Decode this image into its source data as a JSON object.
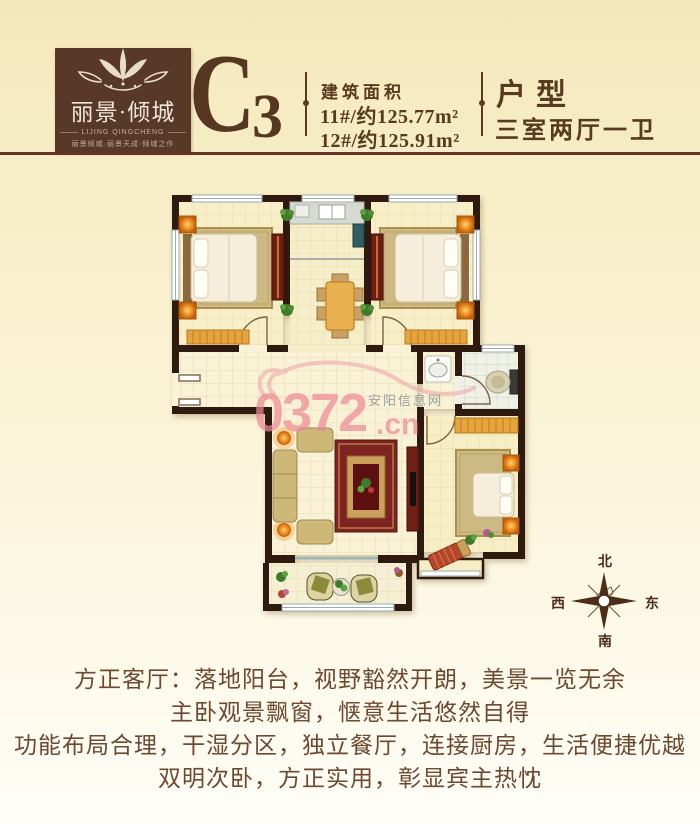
{
  "header": {
    "logo": {
      "brand": "丽景·倾城",
      "brand_en": "LIJING QINGCHENG",
      "tagline": "丽景倾城·丽景天成·倾城之作"
    },
    "unit_code": "C",
    "unit_sub": "3",
    "area": {
      "label": "建筑面积",
      "line1": "11#/约125.77m²",
      "line2": "12#/约125.91m²"
    },
    "type": {
      "label": "户型",
      "value": "三室两厅一卫"
    }
  },
  "watermark": {
    "big": "0372",
    "suffix": ".cn",
    "site": "安阳信息网"
  },
  "compass": {
    "north": "北",
    "south": "南",
    "east": "东",
    "west": "西"
  },
  "description": {
    "lines": [
      "方正客厅：落地阳台，视野豁然开朗，美景一览无余",
      "主卧观景飘窗，惬意生活悠然自得",
      "功能布局合理，干湿分区，独立餐厅，连接厨房，生活便捷优越",
      "双明次卧，方正实用，彰显宾主热忱"
    ]
  },
  "colors": {
    "background_top": "#f4e8ba",
    "header_brown": "#583a20",
    "logo_box": "#583827",
    "rule": "#653427",
    "wall": "#2e1a0f",
    "floor_cream": "#f8efc8",
    "bay_orange": "#e6a43f",
    "wardrobe_red": "#6f1c12",
    "watermark_pink": "#ee8a95",
    "compass_brown": "#4b2d1a"
  }
}
